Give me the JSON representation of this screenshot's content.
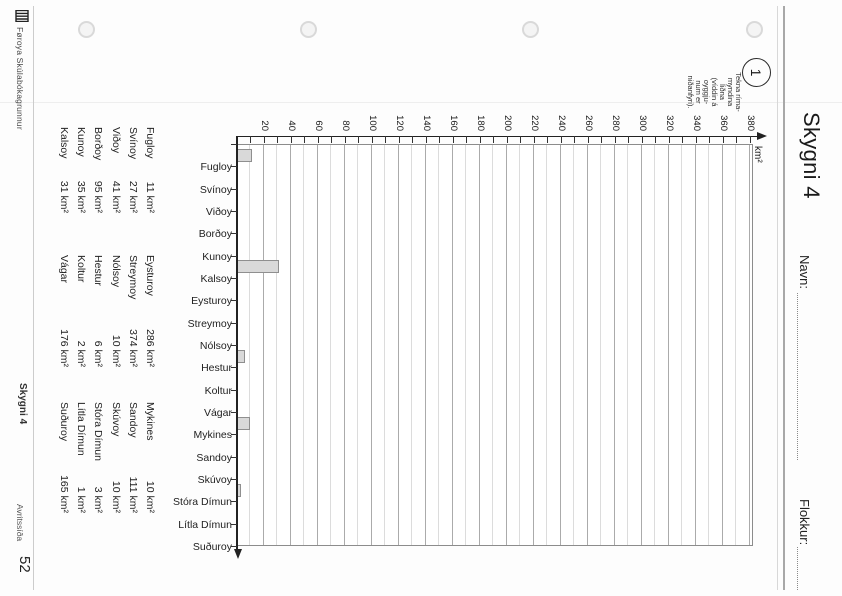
{
  "header": {
    "title": "Skygni 4",
    "name_label": "Navn:",
    "class_label": "Flokkur:"
  },
  "task": {
    "number": "1",
    "instruction_lines": [
      "Tekna ríma-",
      "myndina",
      "liðna",
      "(víddin á",
      "oyggju-",
      "num er",
      "niðanfyri)."
    ]
  },
  "chart_data": {
    "type": "bar",
    "title": "",
    "xlabel": "",
    "ylabel": "km²",
    "ylim": [
      0,
      380
    ],
    "ytick_labels": [
      20,
      40,
      60,
      80,
      100,
      120,
      140,
      160,
      180,
      200,
      220,
      240,
      260,
      280,
      300,
      320,
      340,
      360,
      380
    ],
    "ytick_minor_step": 10,
    "grid": "horizontal gridlines, minor every 10, darker every 20",
    "legend": "none",
    "categories": [
      "Fugloy",
      "Svínoy",
      "Viðoy",
      "Borðoy",
      "Kunoy",
      "Kalsoy",
      "Eysturoy",
      "Streymoy",
      "Nólsoy",
      "Hestur",
      "Koltur",
      "Vágar",
      "Mykines",
      "Sandoy",
      "Skúvoy",
      "Stóra Dímun",
      "Lítla Dímun",
      "Suðuroy"
    ],
    "values": [
      11,
      null,
      null,
      null,
      null,
      31,
      null,
      null,
      null,
      6,
      null,
      null,
      10,
      null,
      null,
      3,
      null,
      null
    ],
    "bar_fill": "#d9d9d9",
    "bar_border": "#8f8f8f"
  },
  "area_table": {
    "unit": "km²",
    "columns": [
      [
        {
          "name": "Fugloy",
          "area_km2": 11
        },
        {
          "name": "Svínoy",
          "area_km2": 27
        },
        {
          "name": "Viðoy",
          "area_km2": 41
        },
        {
          "name": "Borðoy",
          "area_km2": 95
        },
        {
          "name": "Kunoy",
          "area_km2": 35
        },
        {
          "name": "Kalsoy",
          "area_km2": 31
        }
      ],
      [
        {
          "name": "Eysturoy",
          "area_km2": 286
        },
        {
          "name": "Streymoy",
          "area_km2": 374
        },
        {
          "name": "Nólsoy",
          "area_km2": 10
        },
        {
          "name": "Hestur",
          "area_km2": 6
        },
        {
          "name": "Koltur",
          "area_km2": 2
        },
        {
          "name": "Vágar",
          "area_km2": 176
        }
      ],
      [
        {
          "name": "Mykines",
          "area_km2": 10
        },
        {
          "name": "Sandoy",
          "area_km2": 111
        },
        {
          "name": "Skúvoy",
          "area_km2": 10
        },
        {
          "name": "Stóra Dímun",
          "area_km2": 3
        },
        {
          "name": "Lítla Dímun",
          "area_km2": 1
        },
        {
          "name": "Suðuroy",
          "area_km2": 165
        }
      ]
    ]
  },
  "footer": {
    "publisher": "Føroya Skúlabókagrunnur",
    "sheet_title": "Skygni 4",
    "page_label": "Avritssíða",
    "page_number": "52"
  }
}
